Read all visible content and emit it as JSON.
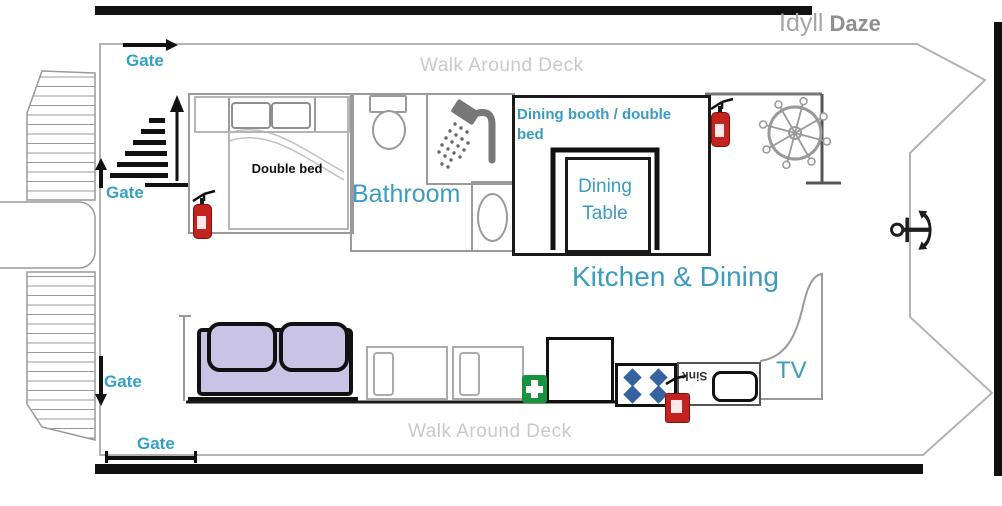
{
  "boat_name": {
    "first": "Idyll",
    "second": "Daze"
  },
  "deck": {
    "top": "Walk Around Deck",
    "bottom": "Walk Around Deck"
  },
  "gates": {
    "top": "Gate",
    "left_upper": "Gate",
    "left_lower": "Gate",
    "bottom": "Gate"
  },
  "rooms": {
    "bedroom": {
      "label": "Double bed"
    },
    "bathroom": {
      "label": "Bathroom"
    },
    "dining_booth": {
      "label": "Dining booth / double bed",
      "table": "Dining Table"
    },
    "kitchen": {
      "label": "Kitchen & Dining",
      "sink": "Sink"
    },
    "lounge": {
      "tv": "TV"
    }
  },
  "icons": {
    "anchor_glyph": "⚓"
  },
  "colors": {
    "label_teal": "#3b9cc0",
    "gate_teal": "#35a0c4",
    "deck_text_gray": "#c9c9c9",
    "sofa_lavender": "#c9c3e6",
    "burner_blue": "#35639f",
    "first_aid_green": "#18923f",
    "extinguisher_red": "#c42420"
  }
}
